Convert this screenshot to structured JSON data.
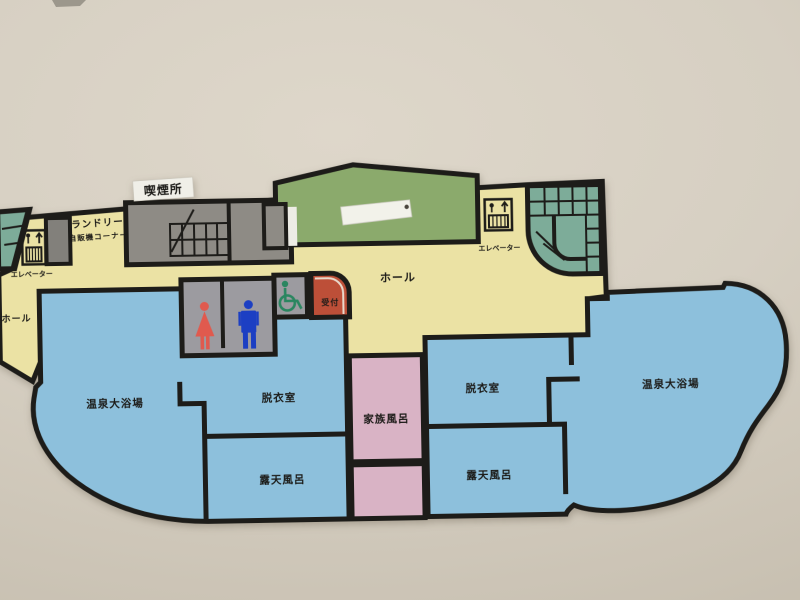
{
  "labels": {
    "smoking_area": "喫煙所",
    "laundry": "ランドリー",
    "vending_corner": "自販機コーナー",
    "elevator_left": "エレベーター",
    "elevator_right": "エレベーター",
    "hall_left": "ホール",
    "hall_center": "ホール",
    "reception": "受付",
    "main_bath_left": "温泉大浴場",
    "main_bath_right": "温泉大浴場",
    "dressing_room_left": "脱衣室",
    "dressing_room_right": "脱衣室",
    "open_air_bath_left": "露天風呂",
    "open_air_bath_right": "露天風呂",
    "family_bath": "家族風呂"
  },
  "icons": {
    "elevator_left": "elevator-icon",
    "elevator_right": "elevator-icon",
    "female_toilet": "female-icon",
    "male_toilet": "male-icon",
    "wheelchair": "wheelchair-accessible-icon",
    "stairs_left": "stairs-icon",
    "stairs_right": "spiral-stairs-icon"
  },
  "colors": {
    "background": "#d6cfc2",
    "wall": "#1d1c19",
    "hall_yellow": "#ebe2a4",
    "entrance_green": "#8baa6c",
    "stairs_teal": "#7dac99",
    "room_gray": "#8e8b85",
    "dark_room_gray": "#82807b",
    "restroom_gray": "#9c9ba0",
    "bath_blue": "#8dc0dc",
    "family_bath_pink": "#d9b3c5",
    "reception_red": "#bd4f38",
    "female_red": "#e05a4e",
    "male_blue": "#1c3fc3",
    "wheelchair_green": "#2a8660",
    "label_white": "#f3f2ea"
  }
}
